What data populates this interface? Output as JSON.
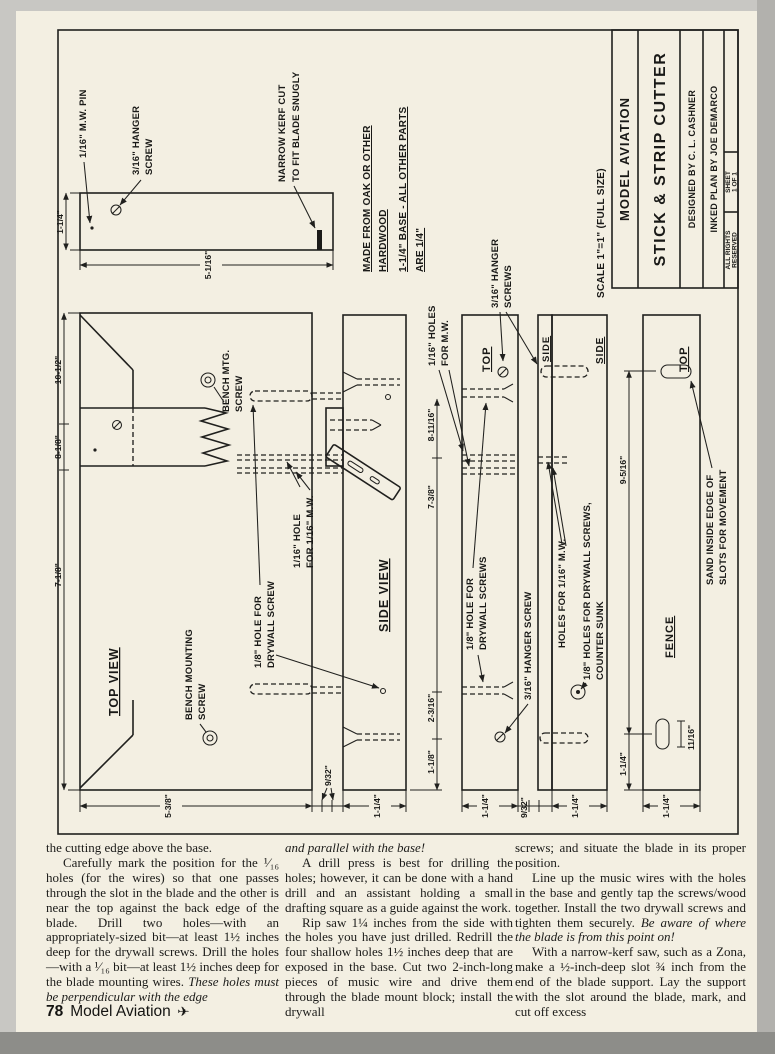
{
  "plan": {
    "support": {
      "pin": "1/16\" M.W. PIN",
      "hanger1": "3/16\" HANGER",
      "hanger2": "SCREW",
      "kerf1": "NARROW KERF CUT",
      "kerf2": "TO FIT BLADE SNUGLY",
      "dim_w": "1-1/4\"",
      "dim_l": "5-1/16\""
    },
    "notes": {
      "l1": "MADE FROM OAK OR OTHER",
      "l2": "HARDWOOD",
      "l3": "1-1/4\" BASE - ALL OTHER PARTS",
      "l4": "ARE 1/4\""
    },
    "scale": "SCALE 1\"=1\" (FULL SIZE)",
    "titleblock": {
      "magazine": "MODEL AVIATION",
      "title": "STICK & STRIP CUTTER",
      "designed": "DESIGNED BY C. L. CASHNER",
      "inked": "INKED PLAN BY JOE DEMARCO",
      "sheet1": "SHEET",
      "sheet2": "1 OF 1",
      "rights1": "ALL RIGHTS",
      "rights2": "RESERVED"
    },
    "topview": {
      "label": "TOP VIEW",
      "dim1": "10-1/2\"",
      "dim2": "8-1/8\"",
      "dim3": "7-1/8\"",
      "dim_bottom": "5-3/8\"",
      "dim_gap": "9/32\"",
      "bench1a": "BENCH MTG.",
      "bench1b": "SCREW",
      "bench2a": "BENCH MOUNTING",
      "bench2b": "SCREW",
      "hole16a": "1/16\" HOLE",
      "hole16b": "FOR 1/16\" M.W.",
      "hole18a": "1/8\" HOLE FOR",
      "hole18b": "DRYWALL SCREW"
    },
    "sideview": {
      "label": "SIDE VIEW",
      "dim1": "8-11/16\"",
      "dim2": "7-3/8\"",
      "dim3": "2-3/16\"",
      "dim4": "1-1/8\"",
      "dim_bottom": "1-1/4\""
    },
    "mwlabel": {
      "a": "1/16\" HOLES",
      "b": "FOR M.W."
    },
    "hangers": {
      "a": "3/16\" HANGER",
      "b": "SCREWS"
    },
    "topstrip": {
      "label": "TOP",
      "drywall1": "1/8\" HOLE FOR",
      "drywall2": "DRYWALL SCREWS",
      "hanger": "3/16\" HANGER SCREW",
      "dim_bottom": "1-1/4\"",
      "dim_gap": "9/32\""
    },
    "sidestrips": {
      "side1": "SIDE",
      "side2": "SIDE",
      "mw": "HOLES FOR 1/16\" M.W.",
      "dw1": "1/8\" HOLES FOR DRYWALL SCREWS,",
      "dw2": "COUNTER SUNK",
      "dim_bottom": "1-1/4\""
    },
    "fence": {
      "top": "TOP",
      "label": "FENCE",
      "slot_len": "11/16\"",
      "dim_slots": "9-5/16\"",
      "dim_end": "1-1/4\"",
      "dim_bottom": "1-1/4\"",
      "sand1": "SAND INSIDE EDGE OF",
      "sand2": "SLOTS FOR MOVEMENT"
    }
  },
  "article": {
    "col1": {
      "intro": "the cutting edge above the base.",
      "p1": "Carefully mark the position for the ¹⁄₁₆ holes (for the wires) so that one passes through the slot in the blade and the other is near the top against the back edge of the blade. Drill two holes—with an appropriately-sized bit—at least 1½ inches deep for the drywall screws. Drill the holes—with a ¹⁄₁₆ bit—at least 1½ inches deep for the blade mounting wires. ",
      "p1_italic": "These holes must be perpendicular with the edge"
    },
    "col2": {
      "lead_italic": "and parallel with the base!",
      "p1": "A drill press is best for drilling the holes; however, it can be done with a hand drill and an assistant holding a small drafting square as a guide against the work.",
      "p2": "Rip saw 1¼ inches from the side with the holes you have just drilled. Redrill the four shallow holes 1½ inches deep that are exposed in the base. Cut two 2-inch-long pieces of music wire and drive them through the blade mount block; install the drywall"
    },
    "col3": {
      "p0": "screws; and situate the blade in its proper position.",
      "p1": "Line up the music wires with the holes in the base and gently tap the screws/wood together. Install the two drywall screws and tighten them securely. ",
      "p1_italic": "Be aware of where the blade is from this point on!",
      "p2": "With a narrow-kerf saw, such as a Zona, make a ½-inch-deep slot ¾ inch from the end of the blade support. Lay the support with the slot around the blade, mark, and cut off excess"
    }
  },
  "footer": {
    "page_number": "78",
    "magazine": "Model Aviation",
    "plane_icon": "✈"
  }
}
